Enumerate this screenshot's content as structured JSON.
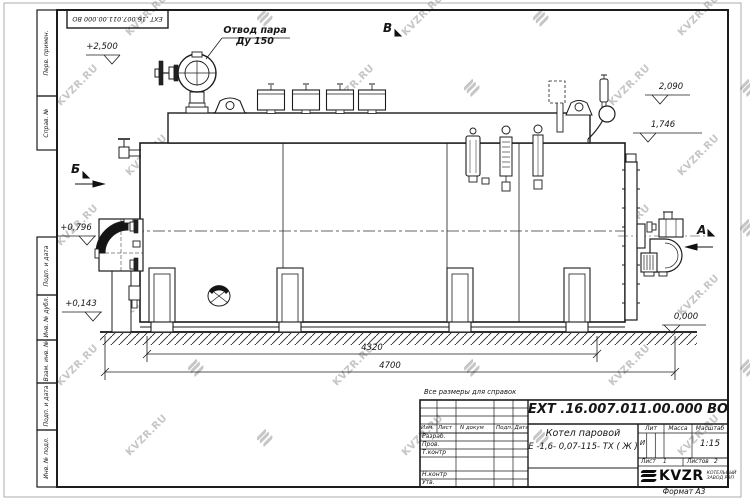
{
  "watermark": {
    "text": "KVZR.RU"
  },
  "doc": {
    "number": "ЕХТ .16.007.011.00.000  ВО"
  },
  "annotations": {
    "steam_outlet_line1": "Отвод пара",
    "steam_outlet_line2": "Ду 150",
    "reference_note": "Все размеры для справок"
  },
  "view_labels": {
    "a": "А",
    "b": "Б",
    "v": "В"
  },
  "elevations": {
    "e2500": "+2,500",
    "e2090": "2,090",
    "e1746": "1,746",
    "e0796": "+0,796",
    "e0143": "+0,143",
    "e0000": "0,000"
  },
  "dimensions": {
    "d4320": "4320",
    "d4700": "4700"
  },
  "titleblock": {
    "title_line1": "Котел паровой",
    "title_line2": "Е -1,6- 0,07-115- ТХ ( Ж )",
    "headers": {
      "izm": "Изм",
      "list": "Лист",
      "n_dokum": "N докум",
      "podp": "Подп.",
      "data": "Дата",
      "lit": "Лит",
      "massa": "Масса",
      "masshtab": "Масштаб"
    },
    "rows": {
      "razrab": "Разраб.",
      "prov": "Пров.",
      "tkontr": "Т.контр",
      "nkontr": "Н.контр",
      "utv": "Утв."
    },
    "lit_value": "И",
    "scale_value": "1:15",
    "sheet": {
      "list_label": "Лист",
      "list_value": "1",
      "listov_label": "Листов",
      "listov_value": "2"
    },
    "logo": {
      "name": "KVZR",
      "sub1": "КОТЕЛЬНЫЙ",
      "sub2": "ЗАВОД РЭП"
    },
    "format": "Формат  А3"
  },
  "margin_labels": {
    "perv": "Перв. примен.",
    "sprav": "Справ. №",
    "podp1": "Подп. и дата",
    "inv_dubl": "Инв. № дубл.",
    "vzam": "Взам. инв. №",
    "podp2": "Подп. и дата",
    "inv_podl": "Инв. № подл."
  }
}
